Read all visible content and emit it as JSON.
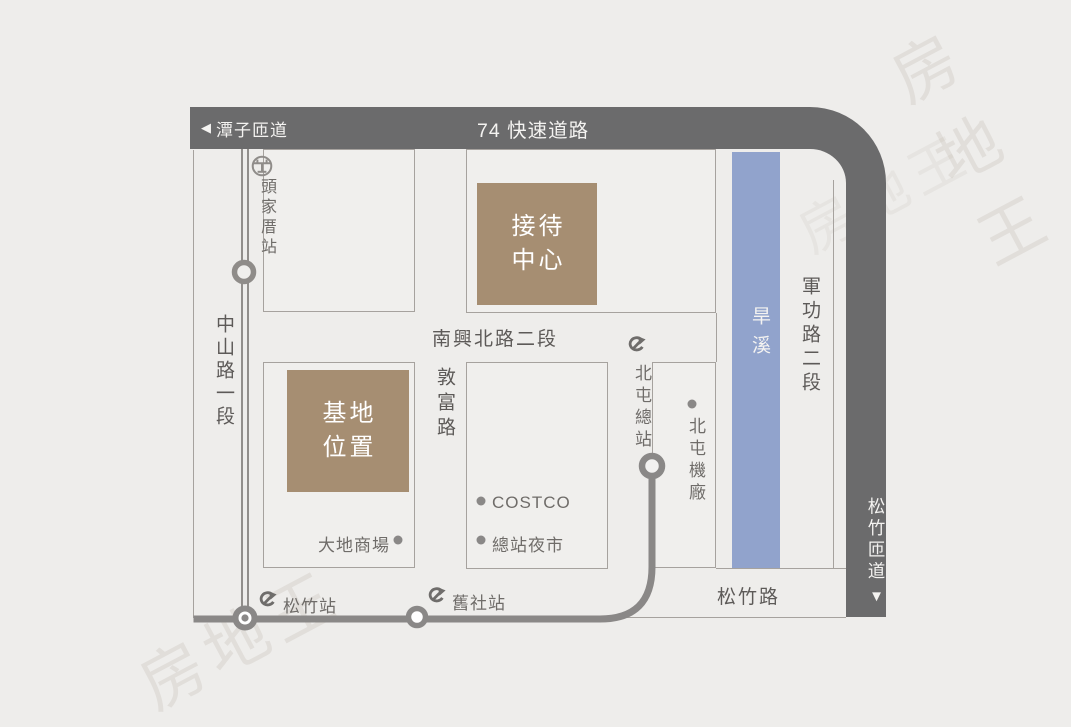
{
  "map": {
    "expressway_label": "74 快速道路",
    "tanzi_ramp_arrow": "◀",
    "tanzi_ramp_label": "潭子匝道",
    "songzhu_ramp_label": "松竹匝道",
    "songzhu_ramp_arrow": "▼",
    "roads": {
      "zhongshan": "中山路一段",
      "nanxing": "南興北路二段",
      "dunfu": "敦富路",
      "jungong": "軍功路二段",
      "songzhu": "松竹路"
    },
    "river": "旱溪",
    "landmarks": {
      "reception_center": {
        "line1": "接待",
        "line2": "中心"
      },
      "site_location": {
        "line1": "基地",
        "line2": "位置"
      }
    },
    "stations": {
      "toujiacuo": "頭家厝站",
      "songzhu": "松竹站",
      "jiushe": "舊社站",
      "beitun_terminal": "北屯總站"
    },
    "pois": {
      "costco": "COSTCO",
      "night_market": "總站夜市",
      "dadi_mall": "大地商場",
      "beitun_depot": "北屯機廠"
    },
    "colors": {
      "expressway_gray": "#6b6b6c",
      "river_blue": "#91a3cc",
      "landmark_tan": "#a68e72",
      "rail_gray": "#8a8887",
      "outline_gray": "#a6a29e",
      "road_text": "#5d5a58",
      "poi_text": "#6f6c69",
      "background": "#eeedeb"
    },
    "watermark": "房地王"
  }
}
